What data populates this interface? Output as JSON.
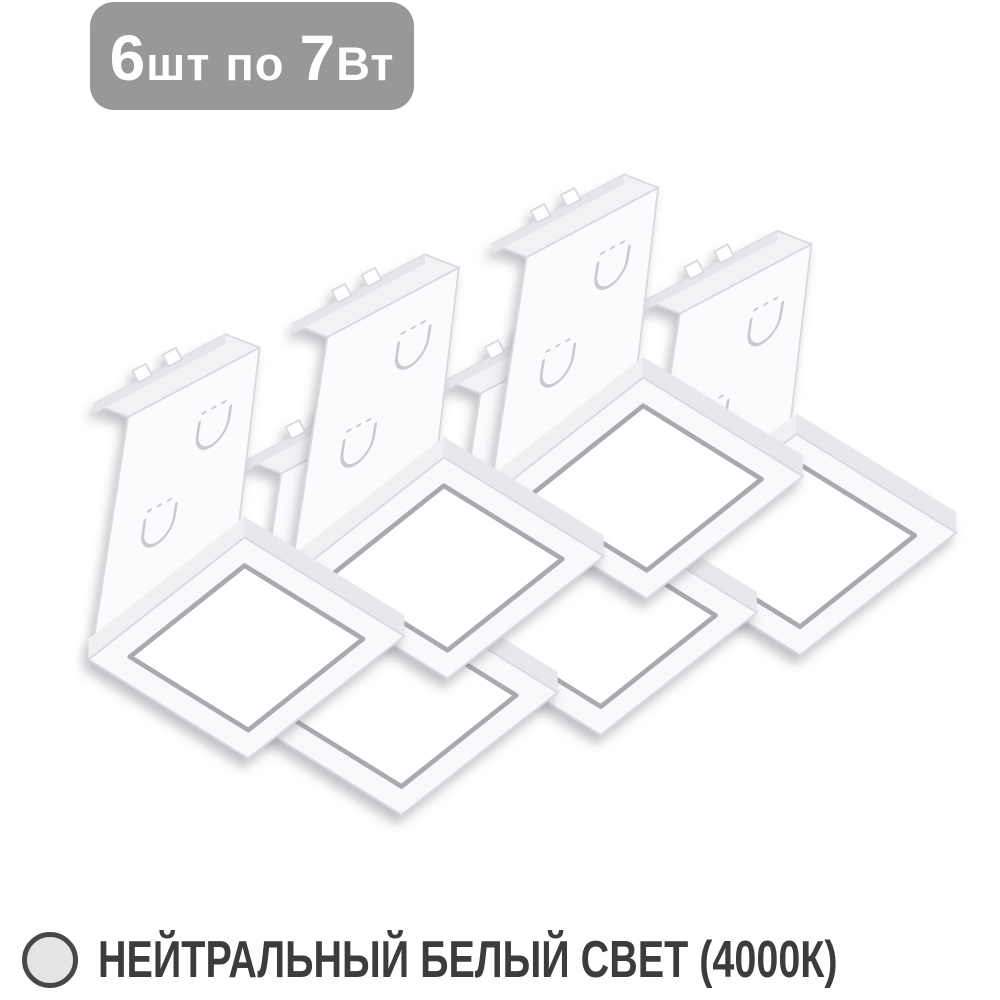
{
  "badge": {
    "full_text": "6шт по 7Вт",
    "segments": [
      {
        "text": "6",
        "emphasis": true
      },
      {
        "text": "шт",
        "emphasis": false
      },
      {
        "text": "по",
        "emphasis": false
      },
      {
        "text": "7",
        "emphasis": true
      },
      {
        "text": "Вт",
        "emphasis": false
      }
    ]
  },
  "product": {
    "description": "set of square LED ceiling panel modules with mounting brackets, isometric render",
    "visible_units": 6
  },
  "footer": {
    "label": "НЕЙТРАЛЬНЫЙ БЕЛЫЙ СВЕТ (4000К)",
    "swatch": "neutral-white-color-circle"
  },
  "colors": {
    "page_bg": "#ffffff",
    "badge_bg": "#98989b",
    "badge_text": "#ffffff",
    "footer_text": "#3c3c3f",
    "circle_fill": "#e4e4e6",
    "circle_stroke": "#48484b",
    "plate": "#fbfbfd",
    "plate_edge": "#d9dadf",
    "flange": "#f2f2f5",
    "lip": "#e6e6ea",
    "band_light": "#f0f0f3",
    "band_dark": "#e8e8ec",
    "panel_frame": "#f9f9fb",
    "panel_face": "#ffffff",
    "rim": "#a9a9b0",
    "ucut": "#c9c9cf",
    "shadow": "#787882"
  }
}
